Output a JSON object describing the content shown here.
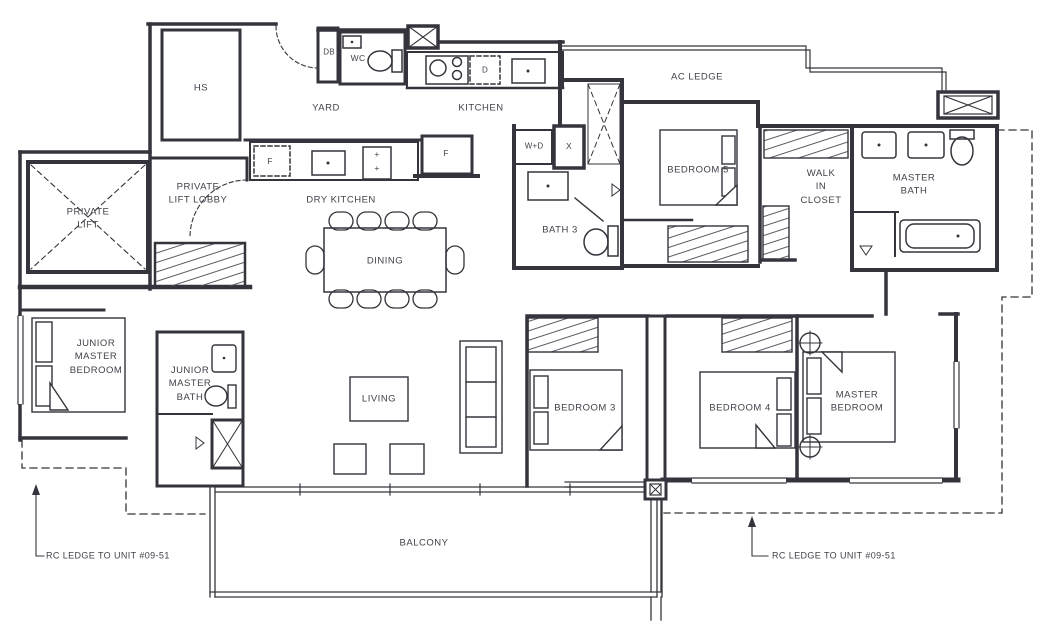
{
  "rooms": {
    "hs": "HS",
    "yard": "YARD",
    "wc": "WC",
    "kitchen": "KITCHEN",
    "dry_kitchen": "DRY KITCHEN",
    "private_lift": "PRIVATE\nLIFT",
    "private_lift_lobby": "PRIVATE\nLIFT LOBBY",
    "dining": "DINING",
    "bath_3": "BATH 3",
    "bedroom_5": "BEDROOM 5",
    "walk_in_closet": "WALK\nIN\nCLOSET",
    "master_bath": "MASTER\nBATH",
    "junior_master_bedroom": "JUNIOR\nMASTER\nBEDROOM",
    "junior_master_bath": "JUNIOR\nMASTER\nBATH",
    "living": "LIVING",
    "bedroom_3": "BEDROOM 3",
    "bedroom_4": "BEDROOM 4",
    "master_bedroom": "MASTER\nBEDROOM",
    "balcony": "BALCONY",
    "ac_ledge": "AC LEDGE"
  },
  "fixtures": {
    "db": "DB",
    "dishwasher": "D",
    "fridge": "F",
    "washer_dryer": "W+D",
    "shower_x": "X",
    "hob_burner": "+"
  },
  "annotations": {
    "rc_ledge_left": "RC LEDGE TO UNIT #09-51",
    "rc_ledge_right": "RC LEDGE TO UNIT #09-51"
  },
  "colors": {
    "wall_line": "#34343c",
    "label_text": "#41414b",
    "background": "#ffffff"
  }
}
